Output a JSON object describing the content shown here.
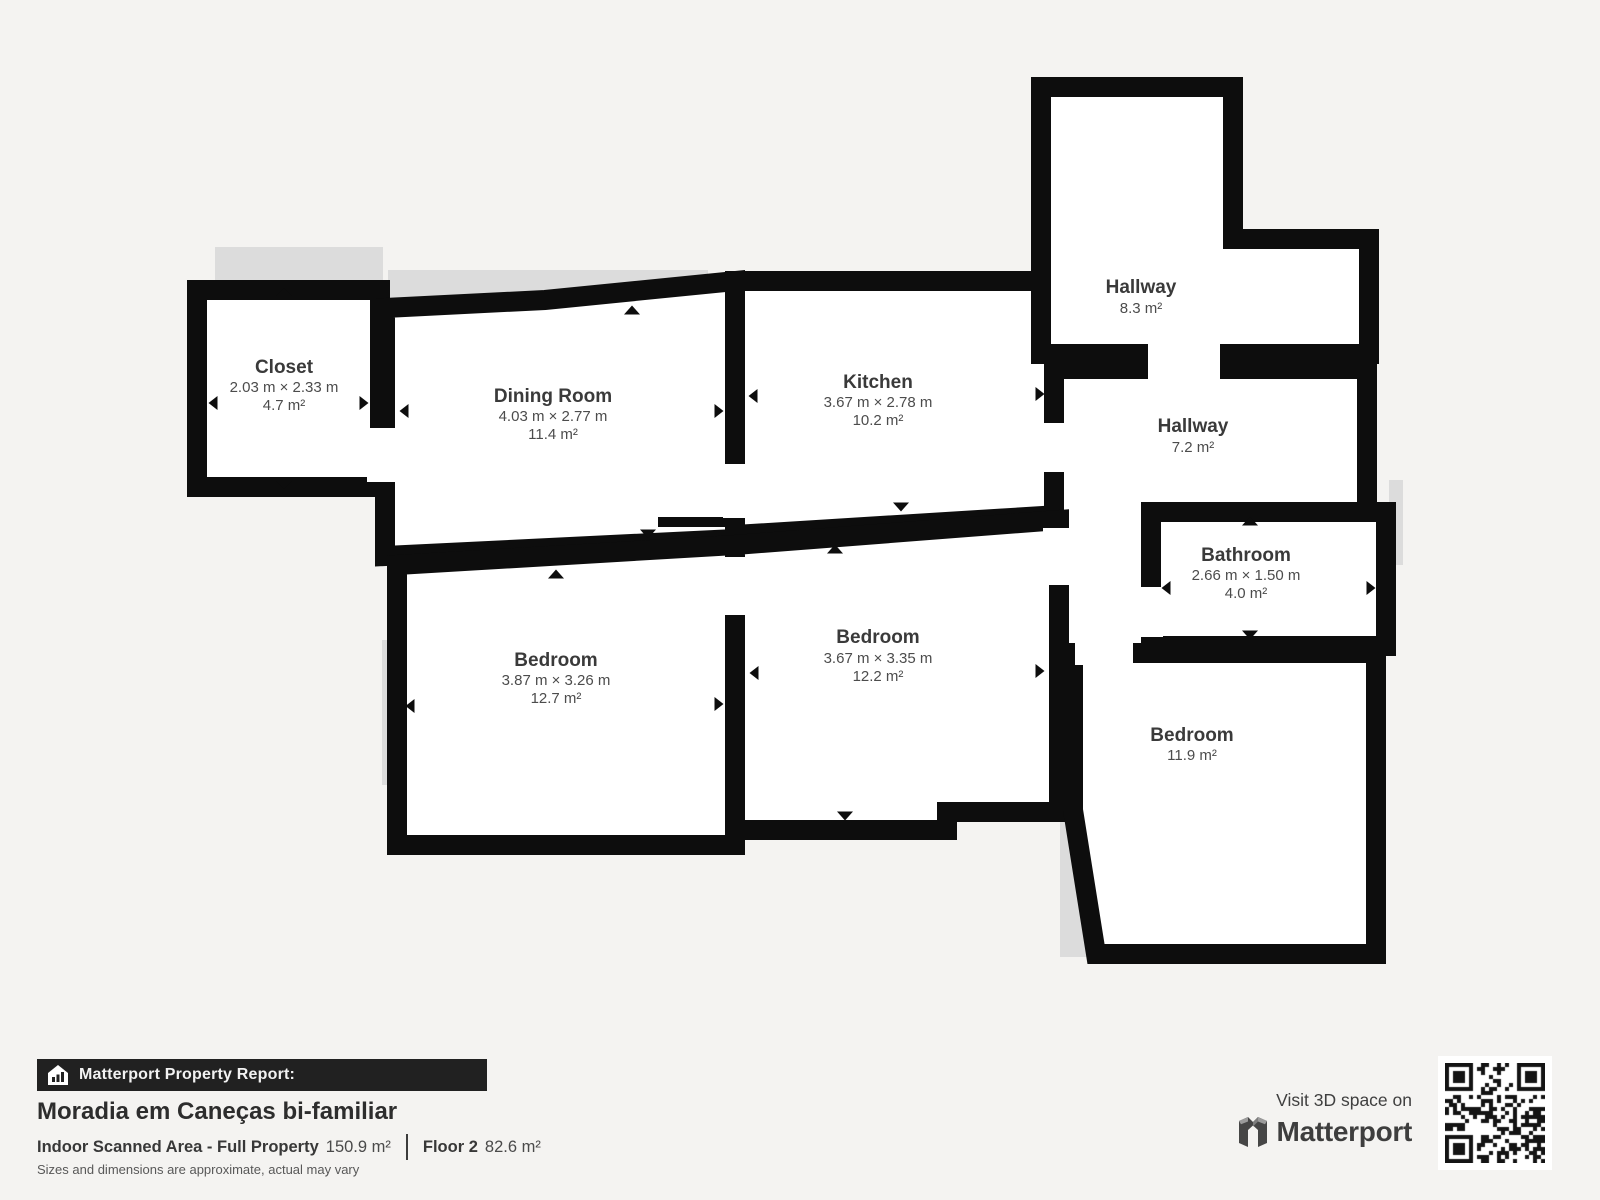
{
  "colors": {
    "background": "#f4f3f1",
    "wall": "#0d0d0d",
    "room_fill": "#ffffff",
    "shadow": "#dcdcdc",
    "banner_bg": "#212121",
    "qr_dark": "#141414"
  },
  "floorplan": {
    "rooms": [
      {
        "id": "closet",
        "name": "Closet",
        "dimensions": "2.03 m × 2.33 m",
        "area": "4.7 m²"
      },
      {
        "id": "dining-room",
        "name": "Dining Room",
        "dimensions": "4.03 m × 2.77 m",
        "area": "11.4 m²"
      },
      {
        "id": "kitchen",
        "name": "Kitchen",
        "dimensions": "3.67 m × 2.78 m",
        "area": "10.2 m²"
      },
      {
        "id": "hallway-upper",
        "name": "Hallway",
        "dimensions": "",
        "area": "8.3 m²"
      },
      {
        "id": "hallway-lower",
        "name": "Hallway",
        "dimensions": "",
        "area": "7.2 m²"
      },
      {
        "id": "bathroom",
        "name": "Bathroom",
        "dimensions": "2.66 m × 1.50 m",
        "area": "4.0 m²"
      },
      {
        "id": "bedroom-left",
        "name": "Bedroom",
        "dimensions": "3.87 m × 3.26 m",
        "area": "12.7 m²"
      },
      {
        "id": "bedroom-middle",
        "name": "Bedroom",
        "dimensions": "3.67 m × 3.35 m",
        "area": "12.2 m²"
      },
      {
        "id": "bedroom-right",
        "name": "Bedroom",
        "dimensions": "",
        "area": "11.9 m²"
      }
    ]
  },
  "report": {
    "banner_label": "Matterport Property Report:",
    "property_title": "Moradia em Caneças bi-familiar",
    "scanned_area_label": "Indoor Scanned Area - Full Property",
    "scanned_area_value": "150.9 m²",
    "floor_label": "Floor 2",
    "floor_value": "82.6 m²",
    "disclaimer": "Sizes and dimensions are approximate, actual may vary"
  },
  "cta": {
    "visit_text": "Visit 3D space on",
    "brand": "Matterport"
  }
}
